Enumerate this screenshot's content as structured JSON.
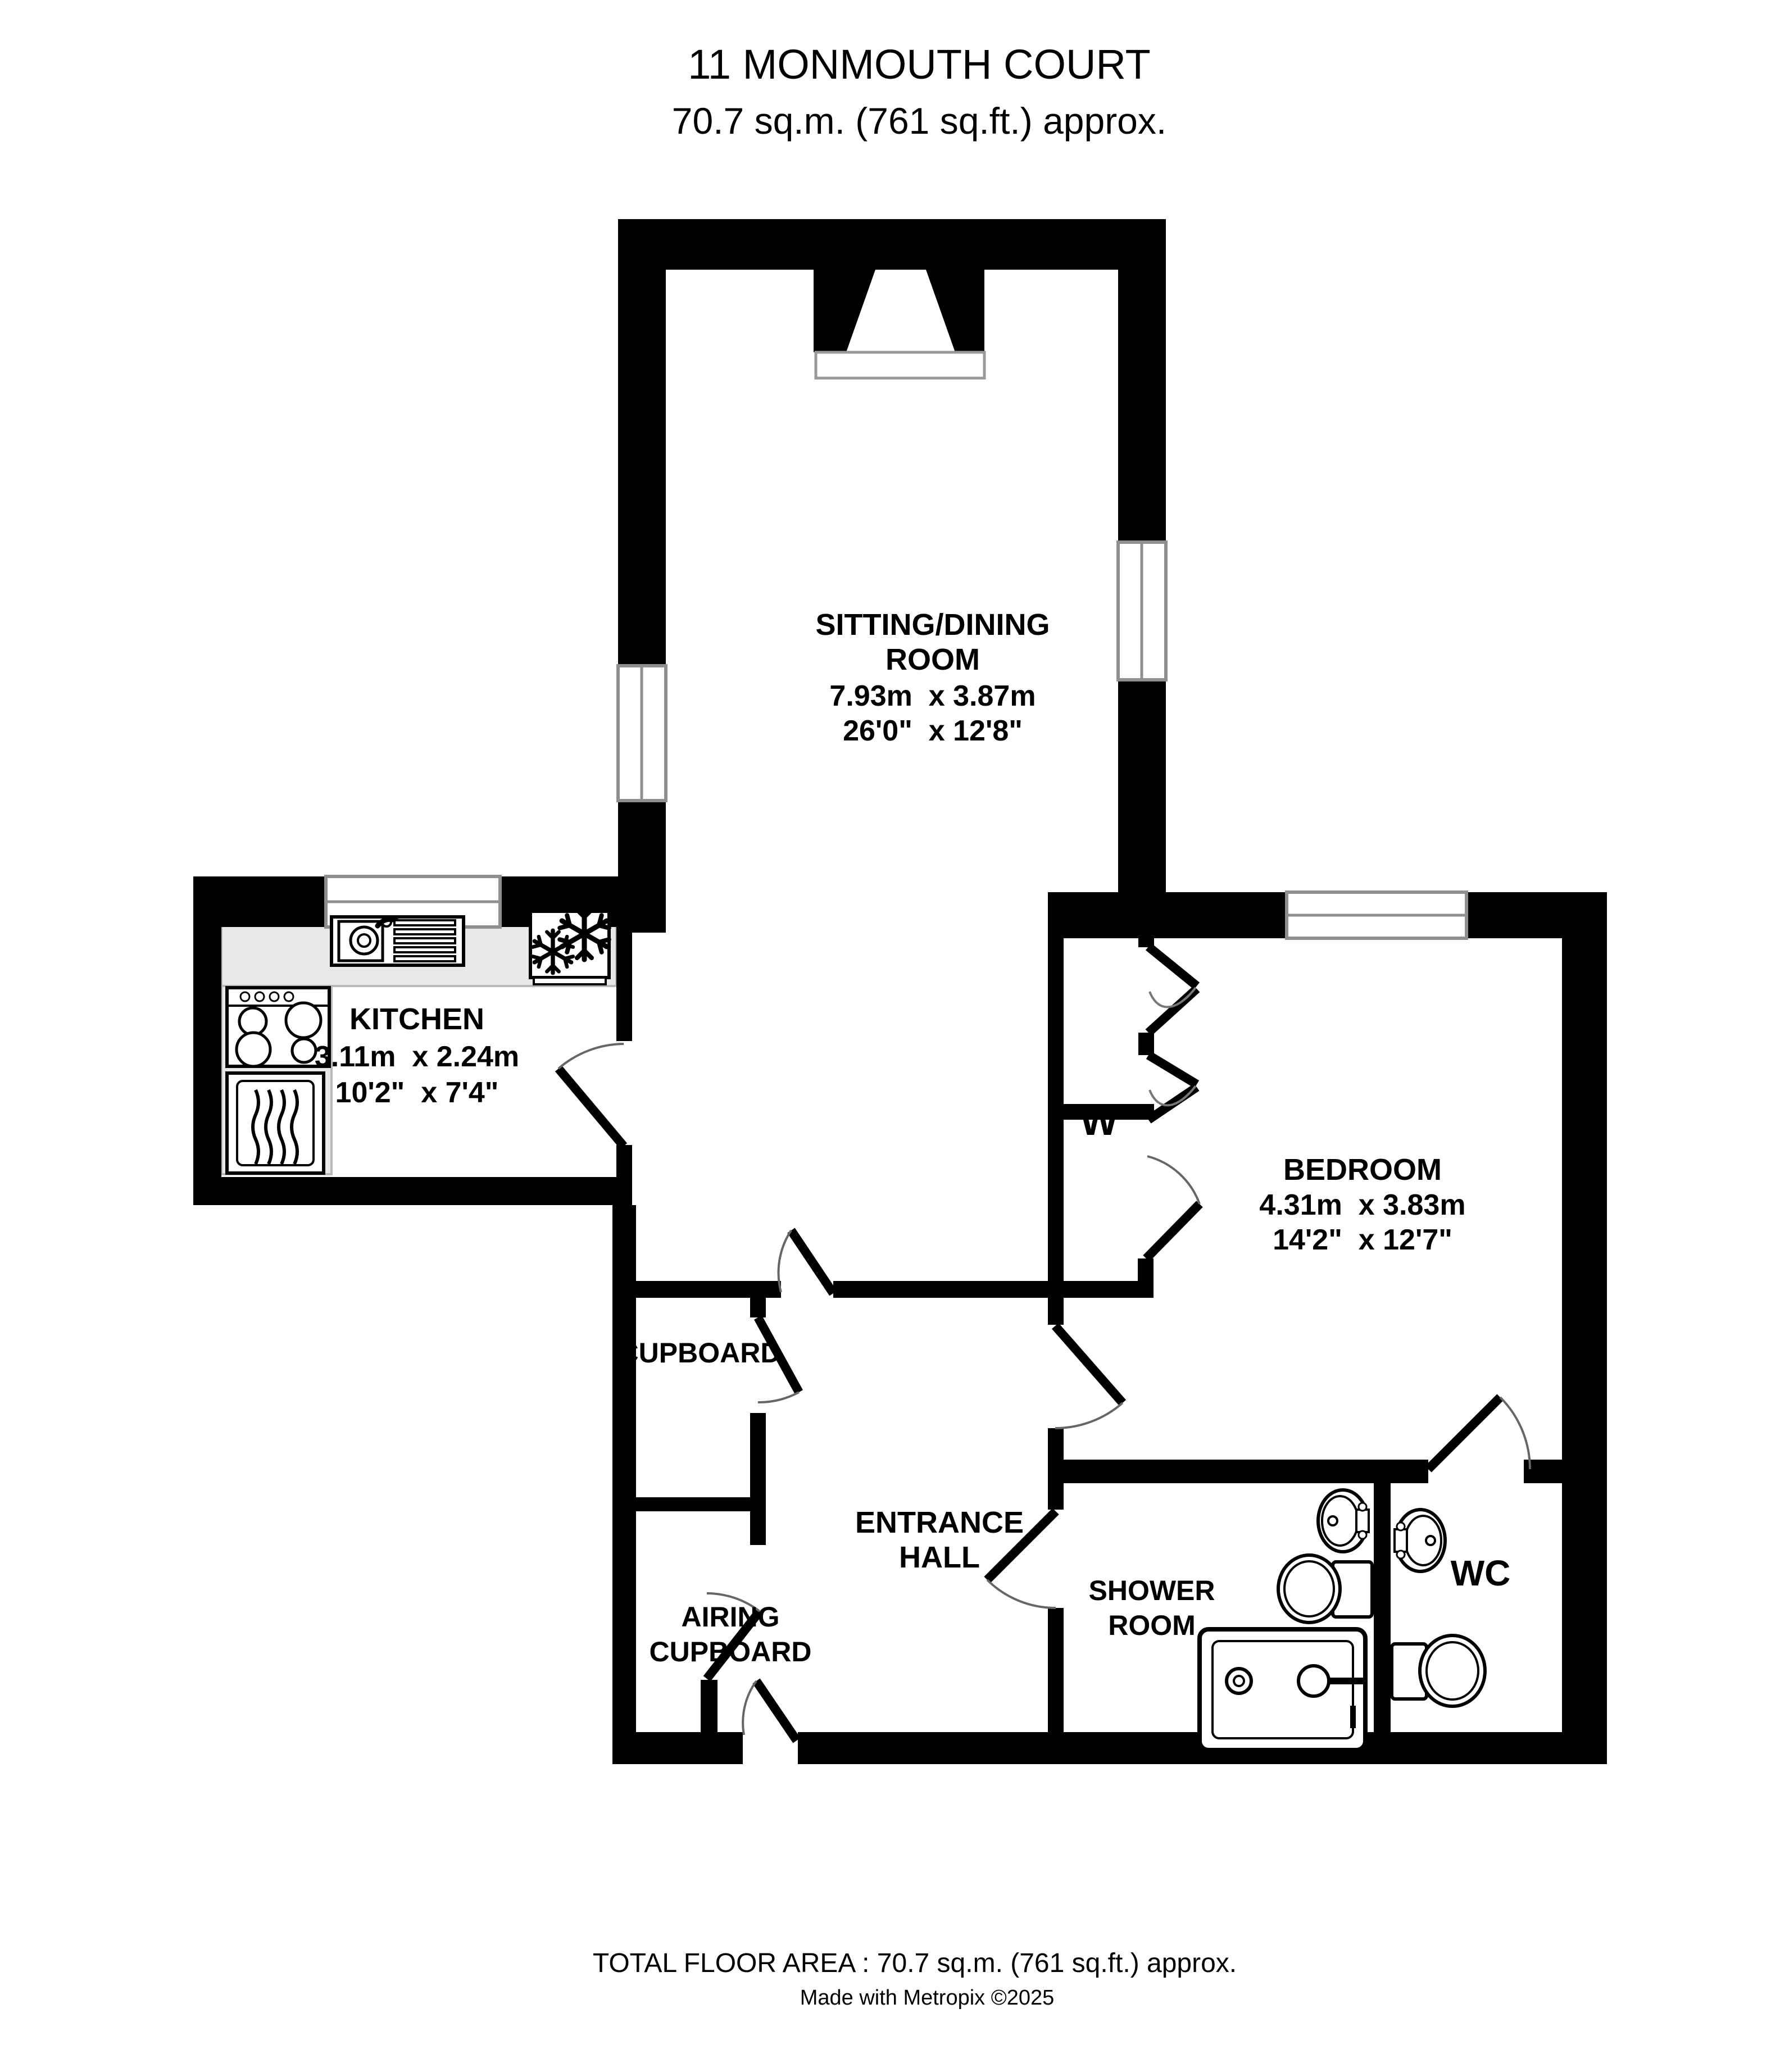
{
  "title": {
    "line1": "11 MONMOUTH COURT",
    "line2": "70.7 sq.m. (761 sq.ft.) approx."
  },
  "rooms": {
    "sitting_dining": {
      "name_line1": "SITTING/DINING",
      "name_line2": "ROOM",
      "dims_metric": "7.93m  x 3.87m",
      "dims_imperial": "26'0\"  x 12'8\""
    },
    "kitchen": {
      "name": "KITCHEN",
      "dims_metric": "3.11m  x 2.24m",
      "dims_imperial": "10'2\"  x 7'4\""
    },
    "bedroom": {
      "name": "BEDROOM",
      "dims_metric": "4.31m  x 3.83m",
      "dims_imperial": "14'2\"  x 12'7\""
    },
    "wardrobe": {
      "name": "W"
    },
    "cupboard": {
      "name": "CUPBOARD"
    },
    "airing_cupboard": {
      "name_line1": "AIRING",
      "name_line2": "CUPBOARD"
    },
    "entrance_hall": {
      "name_line1": "ENTRANCE",
      "name_line2": "HALL"
    },
    "shower_room": {
      "name_line1": "SHOWER",
      "name_line2": "ROOM"
    },
    "wc": {
      "name": "WC"
    }
  },
  "footer": {
    "total_area": "TOTAL FLOOR AREA : 70.7 sq.m. (761 sq.ft.) approx.",
    "credit": "Made with Metropix ©2025"
  },
  "colors": {
    "wall": "#000000",
    "background": "#ffffff",
    "kitchen_counter": "#e8e8e8"
  }
}
